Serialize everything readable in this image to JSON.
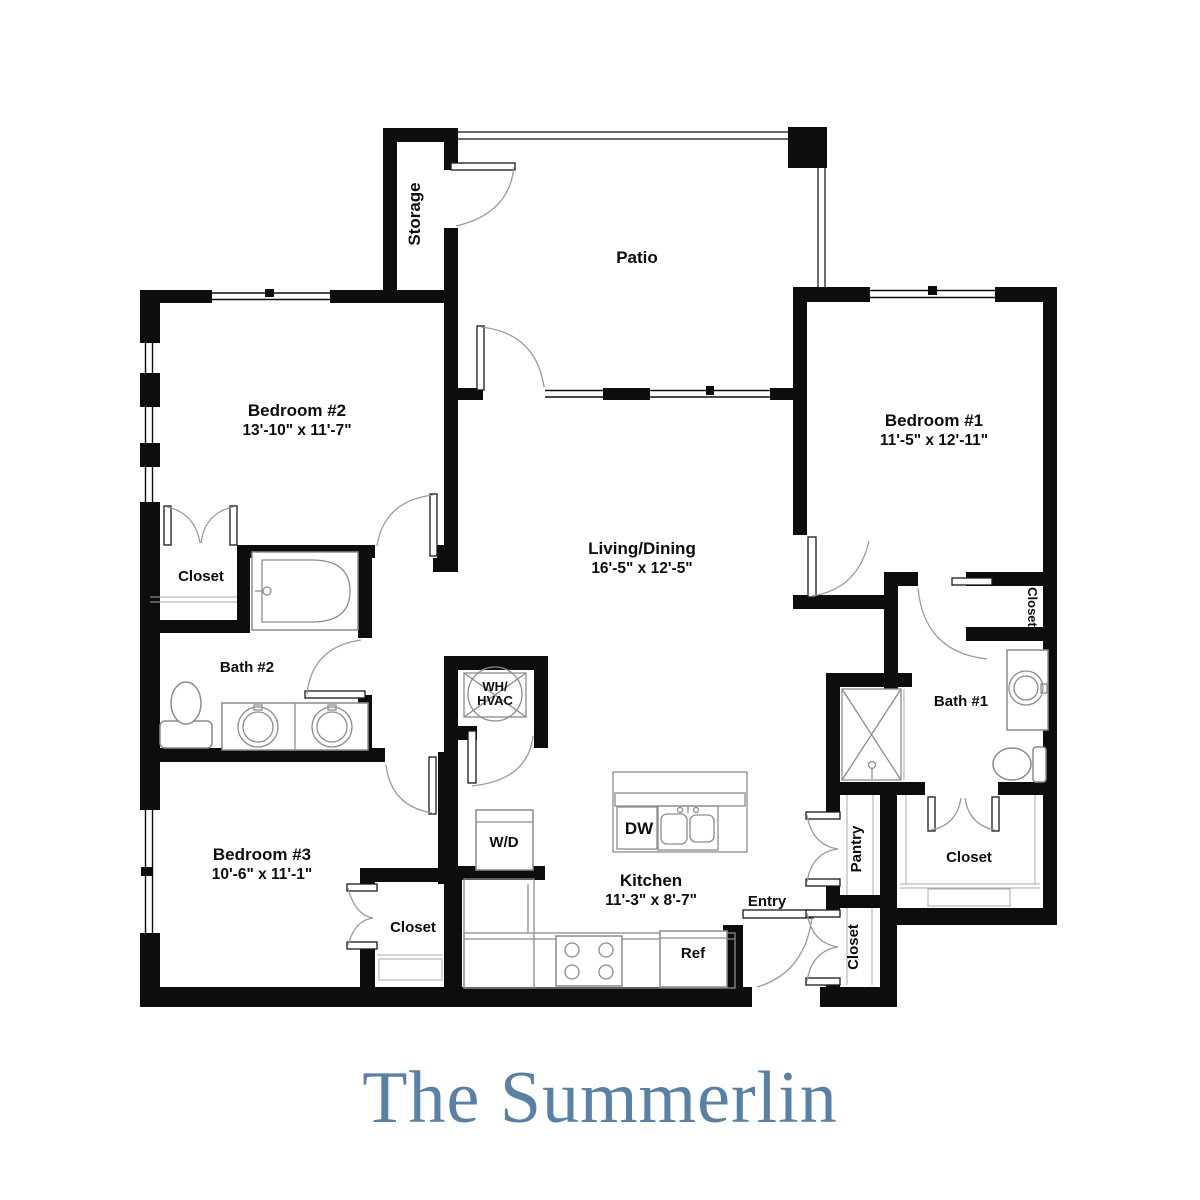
{
  "title": "The Summerlin",
  "colors": {
    "wall": "#0d0d0d",
    "title_text": "#5a81a4",
    "door_arc": "#9a9a9a",
    "fixture_line": "#8c8c8c",
    "background": "#ffffff"
  },
  "rooms": {
    "storage": {
      "name": "Storage"
    },
    "patio": {
      "name": "Patio"
    },
    "bedroom2": {
      "name": "Bedroom #2",
      "dims": "13'-10\" x  11'-7\""
    },
    "bedroom1": {
      "name": "Bedroom #1",
      "dims": "11'-5\" x  12'-11\""
    },
    "living": {
      "name": "Living/Dining",
      "dims": "16'-5\" x 12'-5\""
    },
    "bedroom3": {
      "name": "Bedroom #3",
      "dims": "10'-6\" x  11'-1\""
    },
    "kitchen": {
      "name": "Kitchen",
      "dims": "11'-3\" x 8'-7\""
    },
    "bath2": {
      "name": "Bath #2"
    },
    "bath1": {
      "name": "Bath #1"
    },
    "entry": {
      "name": "Entry"
    },
    "pantry": {
      "name": "Pantry"
    }
  },
  "closets": {
    "bedroom2_closet": "Closet",
    "bedroom3_closet": "Closet",
    "bath1_closet": "Closet",
    "walkin_closet": "Closet",
    "entry_closet": "Closet"
  },
  "fixtures": {
    "wh_hvac_line1": "WH/",
    "wh_hvac_line2": "HVAC",
    "washer_dryer": "W/D",
    "dishwasher": "DW",
    "refrigerator": "Ref"
  }
}
